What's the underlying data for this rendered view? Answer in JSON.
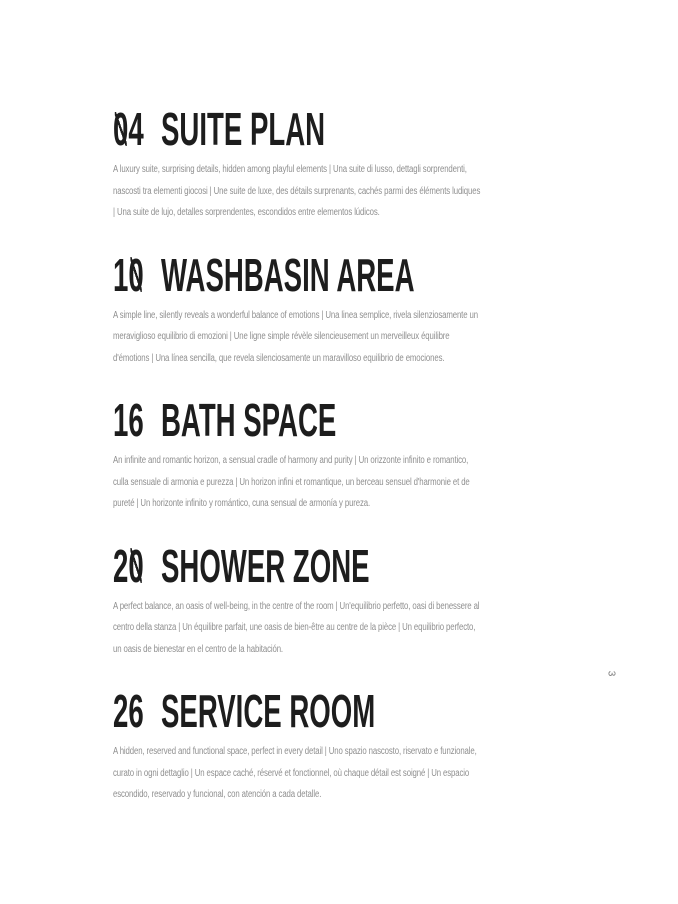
{
  "colors": {
    "page_bg": "#ffffff",
    "heading": "#1d1d1d",
    "body_text": "#8f8f8f",
    "page_number": "#777777"
  },
  "page": {
    "page_number": "3"
  },
  "toc": {
    "entries": [
      {
        "number": "04",
        "title": "SUITE PLAN",
        "description": "A luxury suite, surprising details, hidden among playful elements | Una suite di lusso, dettagli sorprendenti, nascosti tra elementi giocosi | Une suite de luxe, des détails surprenants, cachés parmi des éléments ludiques | Una suite de lujo, detalles sorprendentes, escondidos entre elementos lúdicos."
      },
      {
        "number": "10",
        "title": "WASHBASIN AREA",
        "description": "A simple line, silently reveals a wonderful balance of emotions | Una linea semplice, rivela silenziosamente un meraviglioso equilibrio di emozioni | Une ligne simple révèle silencieusement un merveilleux équilibre d'émotions | Una línea sencilla, que revela silenciosamente un maravilloso equilibrio de emociones."
      },
      {
        "number": "16",
        "title": "BATH SPACE",
        "description": "An infinite and romantic horizon, a sensual cradle of harmony and purity | Un orizzonte infinito e romantico, culla sensuale di armonia e purezza | Un horizon infini et romantique, un berceau sensuel d'harmonie et de pureté | Un horizonte infinito y romántico, cuna sensual de armonía y pureza."
      },
      {
        "number": "20",
        "title": "SHOWER ZONE",
        "description": "A perfect balance, an oasis of well-being, in the centre of the room | Un'equilibrio perfetto, oasi di benessere al centro della stanza | Un équilibre parfait, une oasis de bien-être au centre de la pièce | Un equilibrio perfecto, un oasis de bienestar en el centro de la habitación."
      },
      {
        "number": "26",
        "title": "SERVICE ROOM",
        "description": "A hidden, reserved and functional space, perfect in every detail | Uno spazio nascosto, riservato e funzionale, curato in ogni dettaglio | Un espace caché, réservé et fonctionnel, où chaque détail est soigné | Un espacio escondido, reservado y funcional, con atención a cada detalle."
      }
    ]
  }
}
